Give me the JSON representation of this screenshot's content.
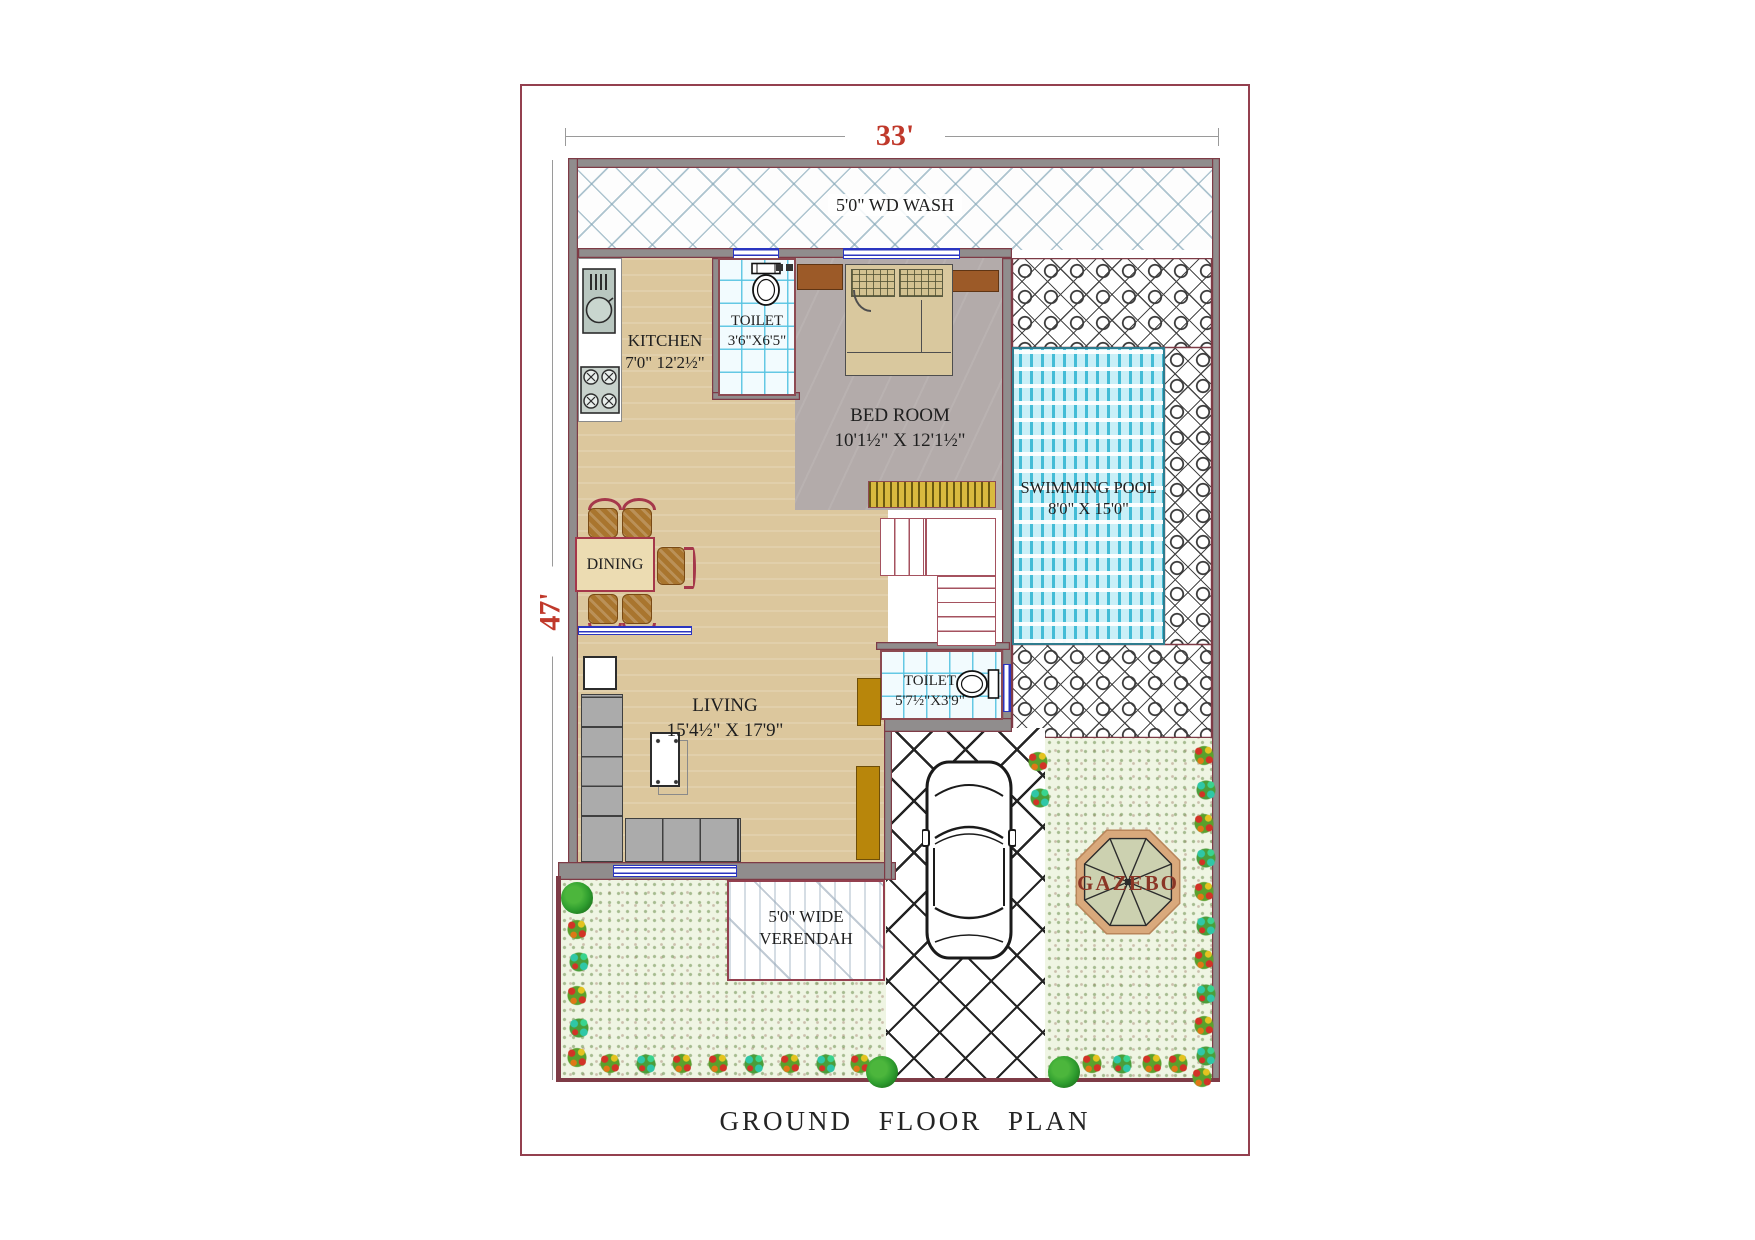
{
  "title": "GROUND  FLOOR  PLAN",
  "dimensions": {
    "width": "33'",
    "height": "47'"
  },
  "rooms": {
    "wd_wash": {
      "label": "5'0\" WD WASH"
    },
    "kitchen": {
      "name": "KITCHEN",
      "size": "7'0\" 12'2½\""
    },
    "toilet1": {
      "name": "TOILET",
      "size": "3'6\"X6'5\""
    },
    "bedroom": {
      "name": "BED ROOM",
      "size": "10'1½\" X 12'1½\""
    },
    "swimming_pool": {
      "name": "SWIMMING POOL",
      "size": "8'0\" X 15'0\""
    },
    "dining": {
      "name": "DINING"
    },
    "living": {
      "name": "LIVING",
      "size": "15'4½\" X 17'9\""
    },
    "toilet2": {
      "name": "TOILET",
      "size": "5'7½\"X3'9\""
    },
    "gazebo": {
      "name": "GAZEBO"
    },
    "verendah": {
      "line1": "5'0\" WIDE",
      "line2": "VERENDAH"
    }
  },
  "colors": {
    "dimension_red": "#c0392b",
    "wall_gray": "#908d8d",
    "wall_outline_maroon": "#7e3b46",
    "floor_tan": "#dcc79d",
    "bedroom_gray": "#b3abaa",
    "pool_blue": "#c9eff7",
    "garden_green": "#eff5e3",
    "paving_white": "#ffffff",
    "railing_gold": "#d9b93f",
    "door_gold": "#b8860b",
    "gazebo_text_maroon": "#8b3626",
    "label_ink": "#1f1f1f"
  }
}
